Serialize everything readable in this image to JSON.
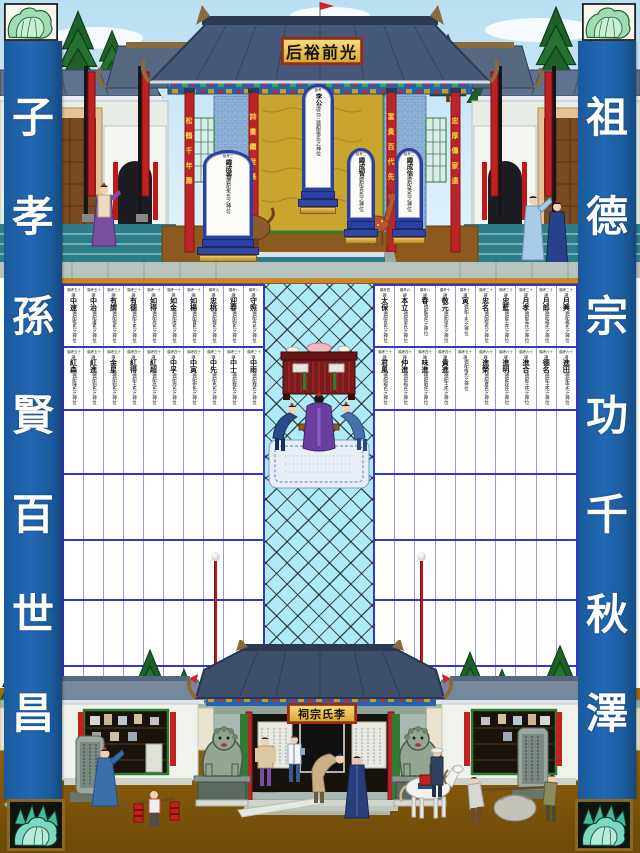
{
  "banners": {
    "left": "子孝孫賢百世昌",
    "right": "祖德宗功千秋澤"
  },
  "top_hall": {
    "plaque": "后裕前光",
    "pillar_couplets": [
      "松鶴千年壽",
      "詩書繼世長",
      "富貴百代先",
      "忠厚傳家遠"
    ],
    "tablets": [
      {
        "header": "祖考三",
        "name": "諱成善",
        "suffix": "德配朱氏之神位"
      },
      {
        "header": "祖考",
        "name": "李公",
        "suffix": "諱元三德配張氏之神位"
      },
      {
        "header": "祖考二",
        "name": "諱成智",
        "suffix": "德配袁氏之神位"
      },
      {
        "header": "祖考二",
        "name": "諱成信",
        "suffix": "德配吳氏之神位"
      }
    ]
  },
  "bottom_hall": {
    "plaque": "祠宗氏李"
  },
  "memorial_grid": {
    "hui_label": "諱",
    "columns": 10,
    "empty_rows": 4,
    "left_block": {
      "filled_rows": [
        [
          {
            "h": "顯考五十",
            "n": "中速",
            "s": "德配張氏之神位"
          },
          {
            "h": "顯考五十",
            "n": "中治",
            "s": "德配盧氏之神位"
          },
          {
            "h": "顯考三十",
            "n": "有謂",
            "s": "德配鄧氏之神位"
          },
          {
            "h": "顯考三十",
            "n": "有德",
            "s": "德配王氏之神位"
          },
          {
            "h": "顯考一十",
            "n": "如得",
            "s": "德配周氏之神位"
          },
          {
            "h": "顯考一十",
            "n": "如金",
            "s": "德配唐氏之神位"
          },
          {
            "h": "顯考一十",
            "n": "如楊",
            "s": "德配賈氏之神位"
          },
          {
            "h": "顯考九",
            "n": "忠桃",
            "s": "德配魏氏之神位"
          },
          {
            "h": "顯考八",
            "n": "迎春",
            "s": "德配劉氏之神位"
          },
          {
            "h": "顯考八",
            "n": "守照",
            "s": "德配冉氏之神位"
          }
        ],
        [
          {
            "h": "顯考五十",
            "n": "紅森",
            "s": "德配陳氏之神位"
          },
          {
            "h": "顯考五十",
            "n": "紅進",
            "s": "德配劉氏之神位"
          },
          {
            "h": "顯考五十",
            "n": "金星",
            "s": "德配劉氏之神位"
          },
          {
            "h": "顯考四十",
            "n": "紅得",
            "s": "德配王氏之神位"
          },
          {
            "h": "顯考四十",
            "n": "紅超",
            "s": "德配高氏之神位"
          },
          {
            "h": "顯考四十",
            "n": "中孚",
            "s": "德配周氏之神位"
          },
          {
            "h": "顯考四十",
            "n": "中寅",
            "s": "德配伊氏之神位"
          },
          {
            "h": "顯考三十",
            "n": "中先",
            "s": "德配馬氏之神位"
          },
          {
            "h": "顯考三十",
            "n": "中士",
            "s": "德配魏氏之神位"
          },
          {
            "h": "顯考三十",
            "n": "中雨",
            "s": "德配魏氏之神位"
          }
        ]
      ]
    },
    "right_block": {
      "filled_rows": [
        [
          {
            "h": "顯考四",
            "n": "太保",
            "s": "德配袁氏之神位"
          },
          {
            "h": "顯考六",
            "n": "本立",
            "s": "德配梁氏之神位"
          },
          {
            "h": "顯考八",
            "n": "春",
            "s": "德配張氏之神位"
          },
          {
            "h": "顯考十",
            "n": "敬元",
            "s": "德配梁氏之神位"
          },
          {
            "h": "顯考十",
            "n": "寅",
            "s": "德配丁氏之神位"
          },
          {
            "h": "顯考二十",
            "n": "忠名",
            "s": "德配張氏之神位"
          },
          {
            "h": "顯考二十",
            "n": "忠藍",
            "s": "德配王氏之神位"
          },
          {
            "h": "顯考二十",
            "n": "月孝",
            "s": "德配朱氏之神位"
          },
          {
            "h": "顯考二十",
            "n": "月郎",
            "s": "德配楊氏之神位"
          },
          {
            "h": "顯考二十",
            "n": "月興",
            "s": "德配楊氏之神位"
          }
        ],
        [
          {
            "h": "顯考三十",
            "n": "君風",
            "s": "德配楊氏之神位"
          },
          {
            "h": "顯考四十",
            "n": "仲進",
            "s": "德配梅氏之神位"
          },
          {
            "h": "顯考四十",
            "n": "味進",
            "s": "德配劉氏之神位"
          },
          {
            "h": "顯考四十",
            "n": "貴進",
            "s": "德配王氏之神位"
          },
          {
            "h": "顯考五十",
            "n": "",
            "s": "德配梅氏之神位"
          },
          {
            "h": "顯考六十",
            "n": "進榮",
            "s": "德配夏氏之神位"
          },
          {
            "h": "顯考六十",
            "n": "進明",
            "s": "德配段氏之神位"
          },
          {
            "h": "顯考六十",
            "n": "進合",
            "s": "德配王氏之神位"
          },
          {
            "h": "顯考六十",
            "n": "德名",
            "s": "德配王氏之神位"
          },
          {
            "h": "顯考六十",
            "n": "進田",
            "s": "德配申氏之神位"
          }
        ]
      ]
    }
  },
  "icons": {
    "corner_motif": "cabbage"
  },
  "colors": {
    "banner_blue": "#2268b4",
    "grid_line_blue": "#3437c8",
    "walkway_cyan": "#aeeaf8",
    "topbar_orange": "#c8862a",
    "plaque_gold": "#d9a62f",
    "pillar_red": "#bb2527",
    "tablet_blue": "#2b3f9e"
  }
}
